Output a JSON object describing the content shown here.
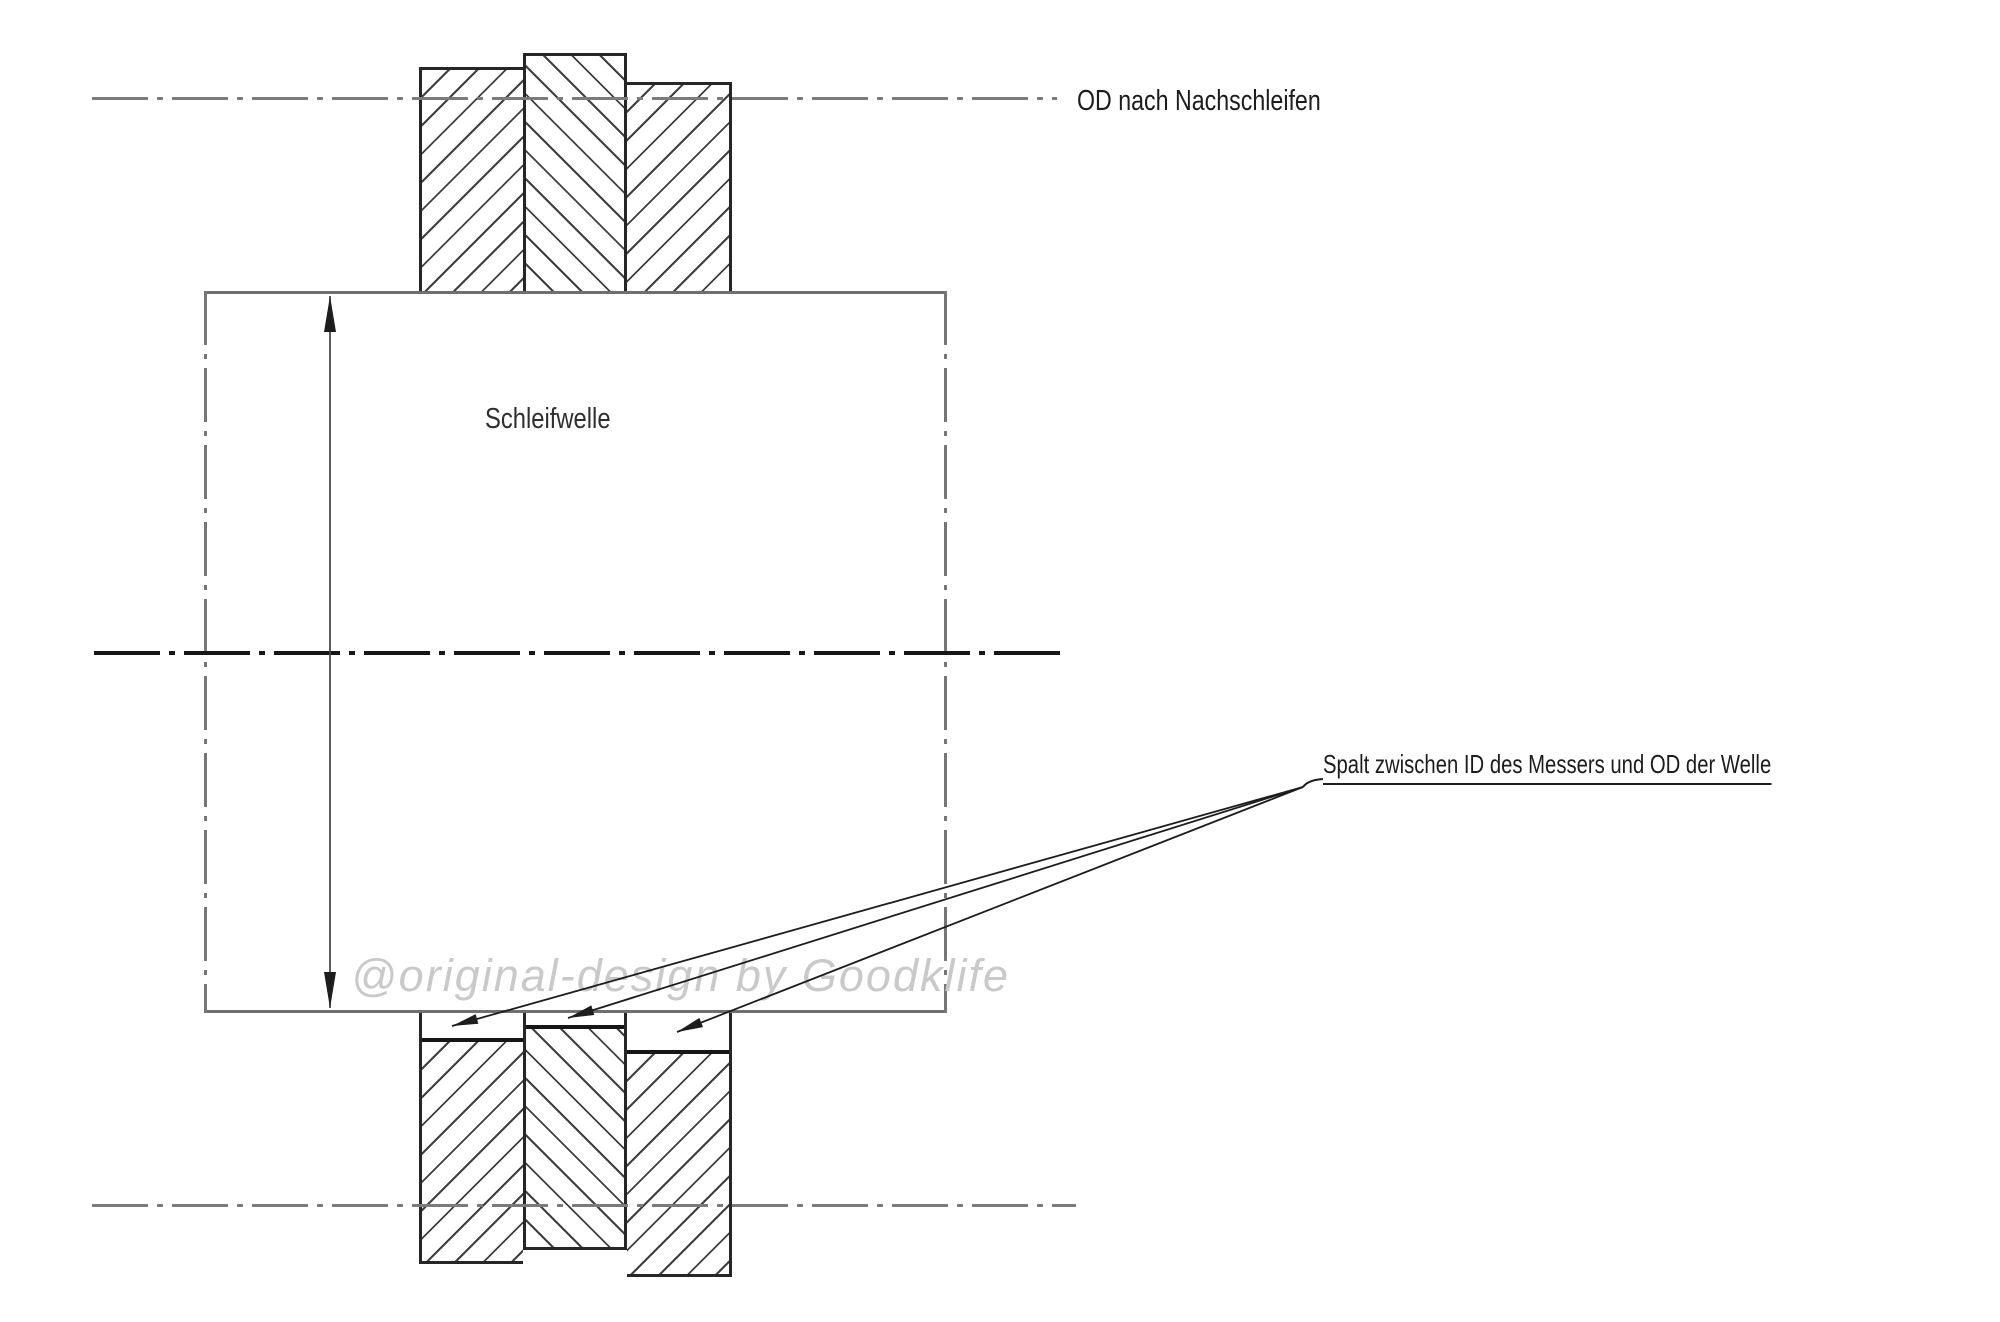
{
  "labels": {
    "od_after_regrind": "OD nach Nachschleifen",
    "shaft": "Schleifwelle",
    "gap": "Spalt zwischen ID des Messers und OD der Welle",
    "watermark": "@original-design by Goodklife"
  },
  "colors": {
    "background": "#ffffff",
    "line_dark": "#1d1d1d",
    "line_gray": "#7b7b7b",
    "hatch": "#3f3f3f",
    "text": "#1c1c1c",
    "watermark": "#c9c9c9"
  },
  "diagram": {
    "type": "technical-section-drawing",
    "top_blades": 3,
    "bottom_blades": 3,
    "leader_arrows": 3
  }
}
